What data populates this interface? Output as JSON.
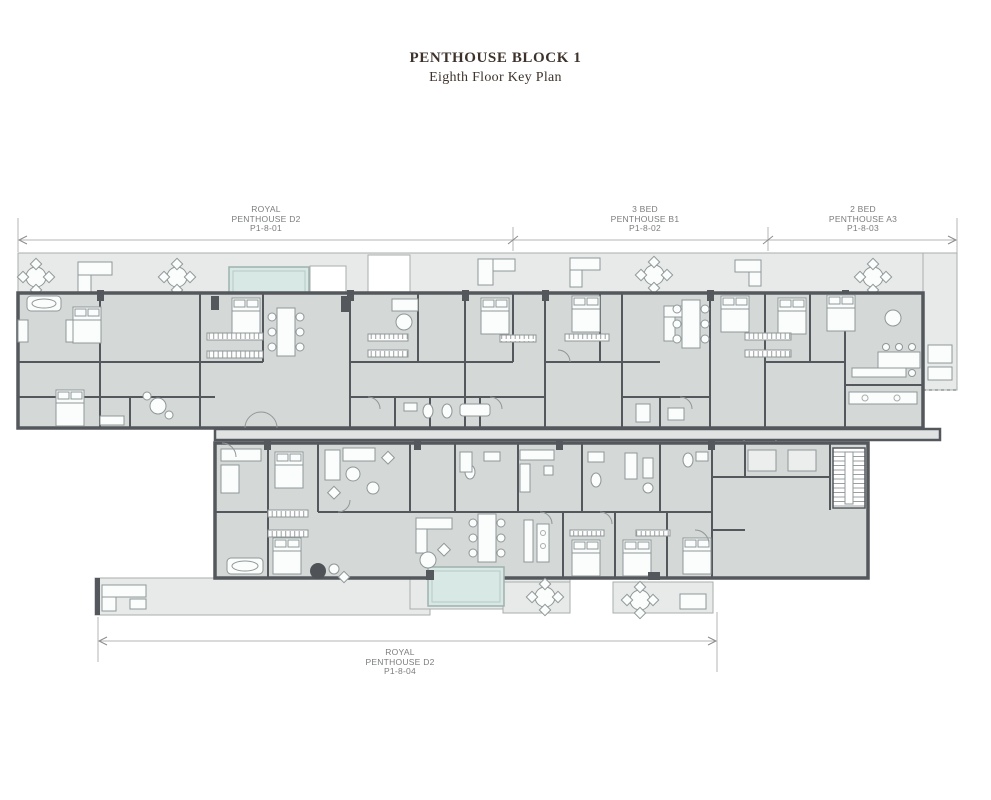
{
  "title": {
    "line1": "PENTHOUSE BLOCK 1",
    "line2": "Eighth Floor Key Plan"
  },
  "units": {
    "u1": {
      "l1": "ROYAL",
      "l2": "PENTHOUSE D2",
      "l3": "P1-8-01"
    },
    "u2": {
      "l1": "3 BED",
      "l2": "PENTHOUSE B1",
      "l3": "P1-8-02"
    },
    "u3": {
      "l1": "2 BED",
      "l2": "PENTHOUSE A3",
      "l3": "P1-8-03"
    },
    "u4": {
      "l1": "ROYAL",
      "l2": "PENTHOUSE D2",
      "l3": "P1-8-04"
    }
  },
  "colors": {
    "wall": "#54585c",
    "room_fill": "#d4d8d7",
    "terrace_fill": "#e7eae9",
    "pool_fill": "#d8e8e4",
    "dimension_line": "#b5b5b5",
    "label_text": "#7a7c7e",
    "title_text": "#3e332c",
    "background": "#ffffff"
  }
}
